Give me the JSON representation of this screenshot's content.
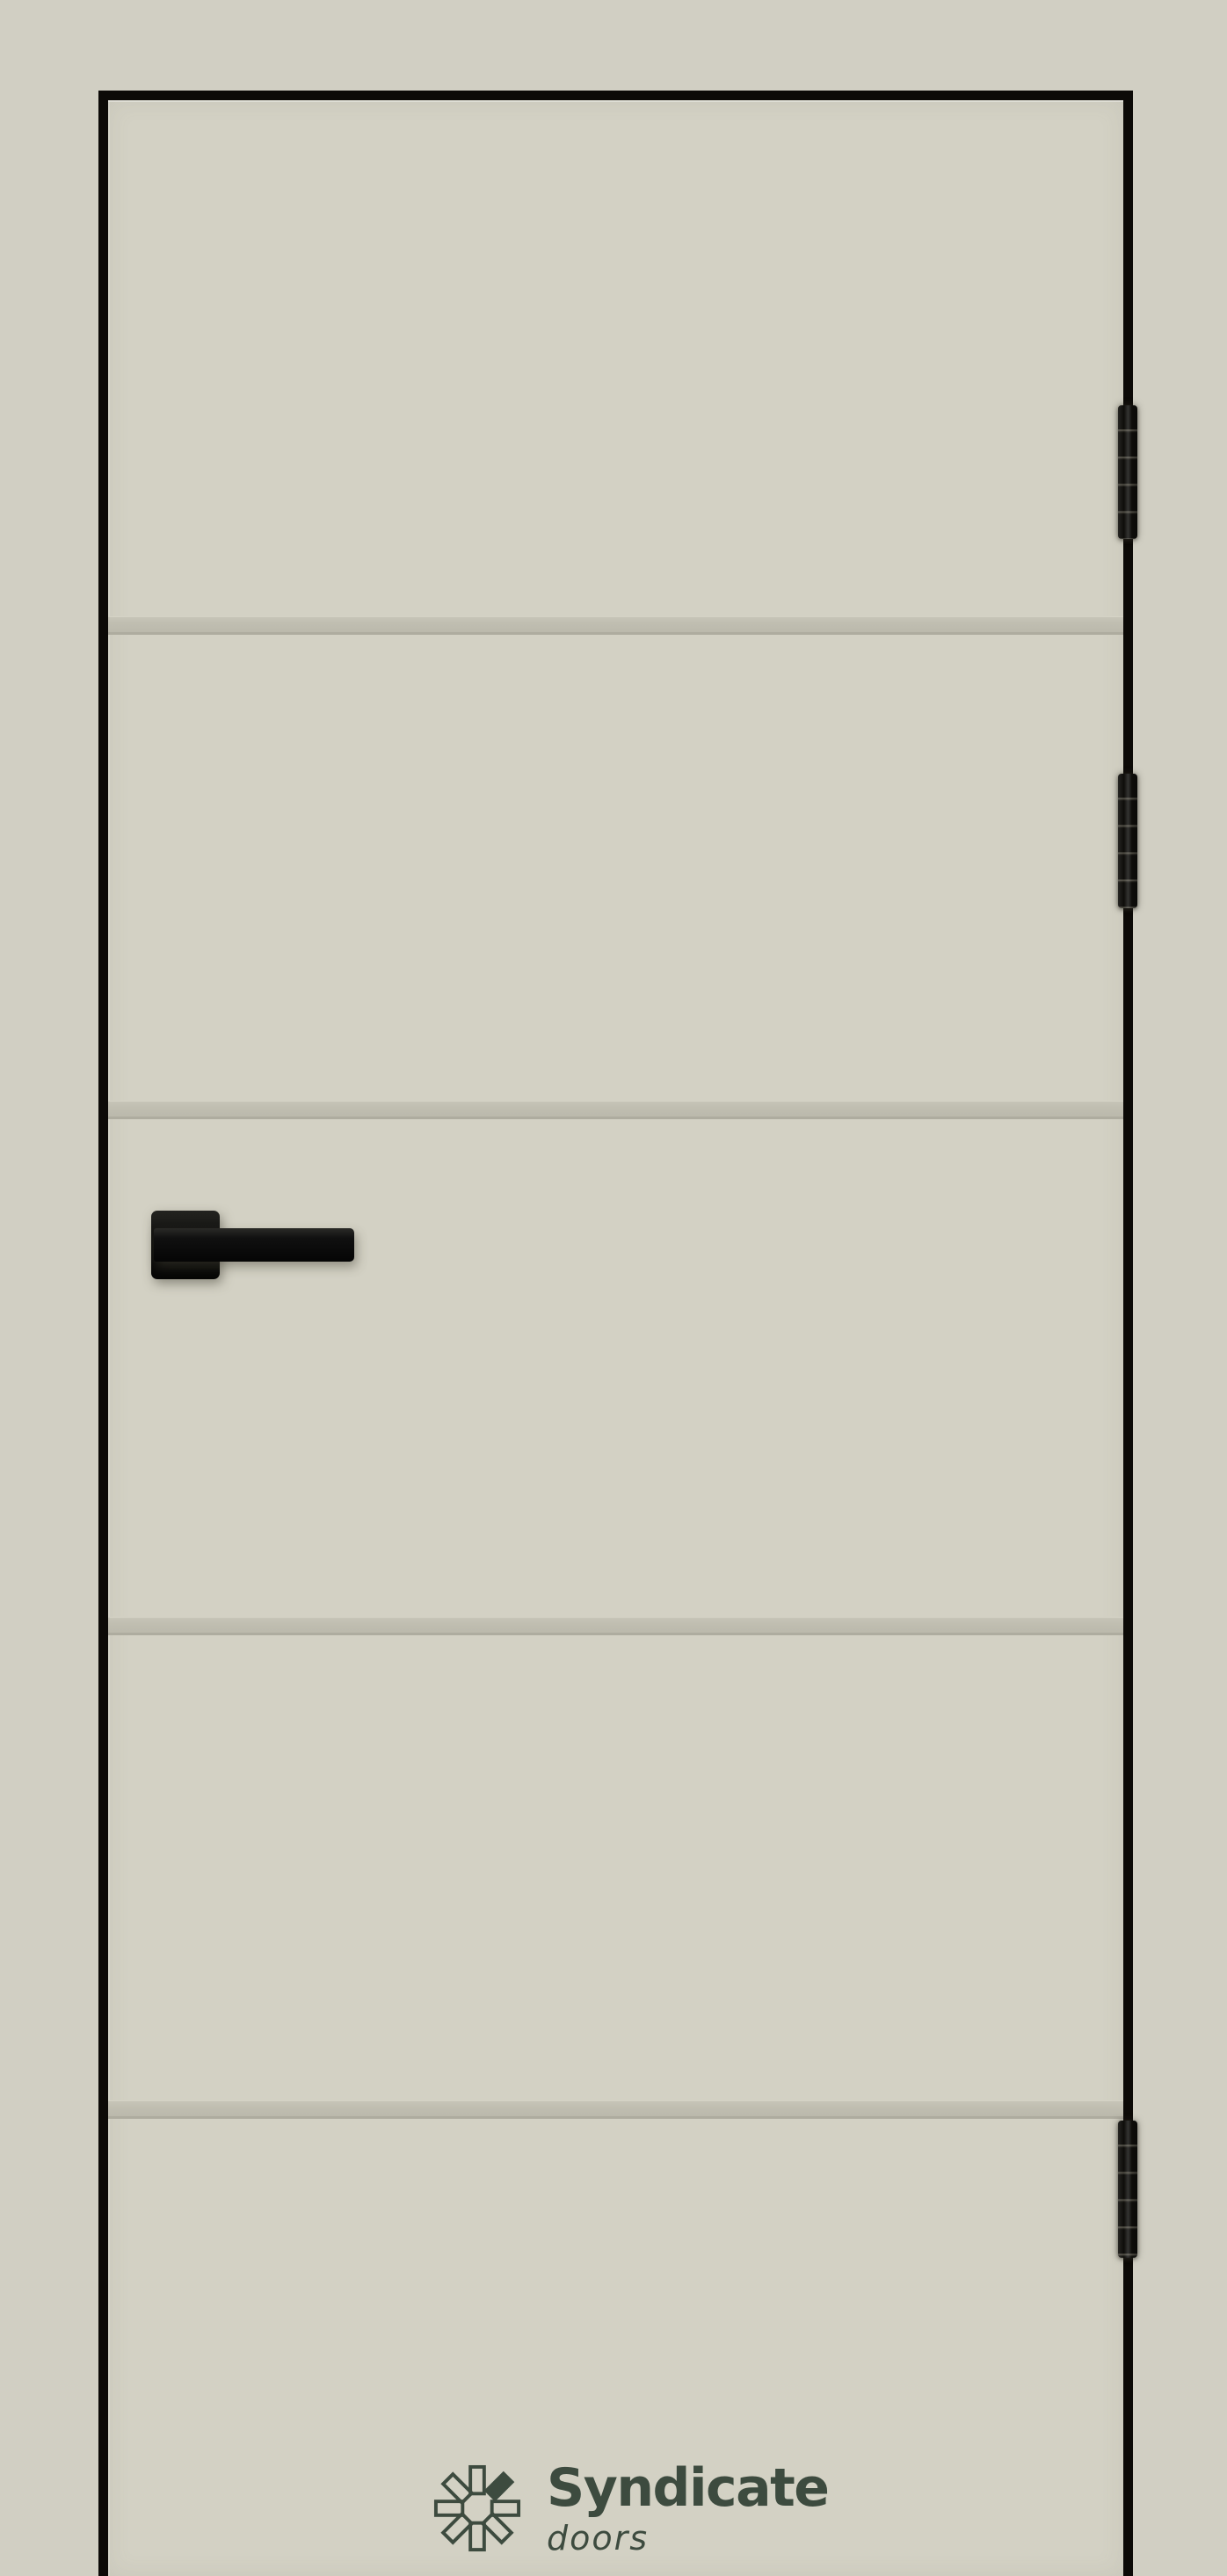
{
  "brand": {
    "name": "Syndicate",
    "tagline": "doors",
    "icon": "pinwheel-logo-icon",
    "logo_color": "#3d4b3f"
  },
  "product": {
    "scene": "door-leaf-product-render",
    "groove_count": 4,
    "hinge_count": 3,
    "handle": "black-square-lever-handle"
  },
  "colors": {
    "background": "#d1cfc3",
    "door_panel": "#d3d1c4",
    "door_frame_edge": "#0c0a07",
    "groove": "#c0beb1",
    "hardware_black": "#0e0d0a",
    "logo_green": "#3d4b3f"
  }
}
